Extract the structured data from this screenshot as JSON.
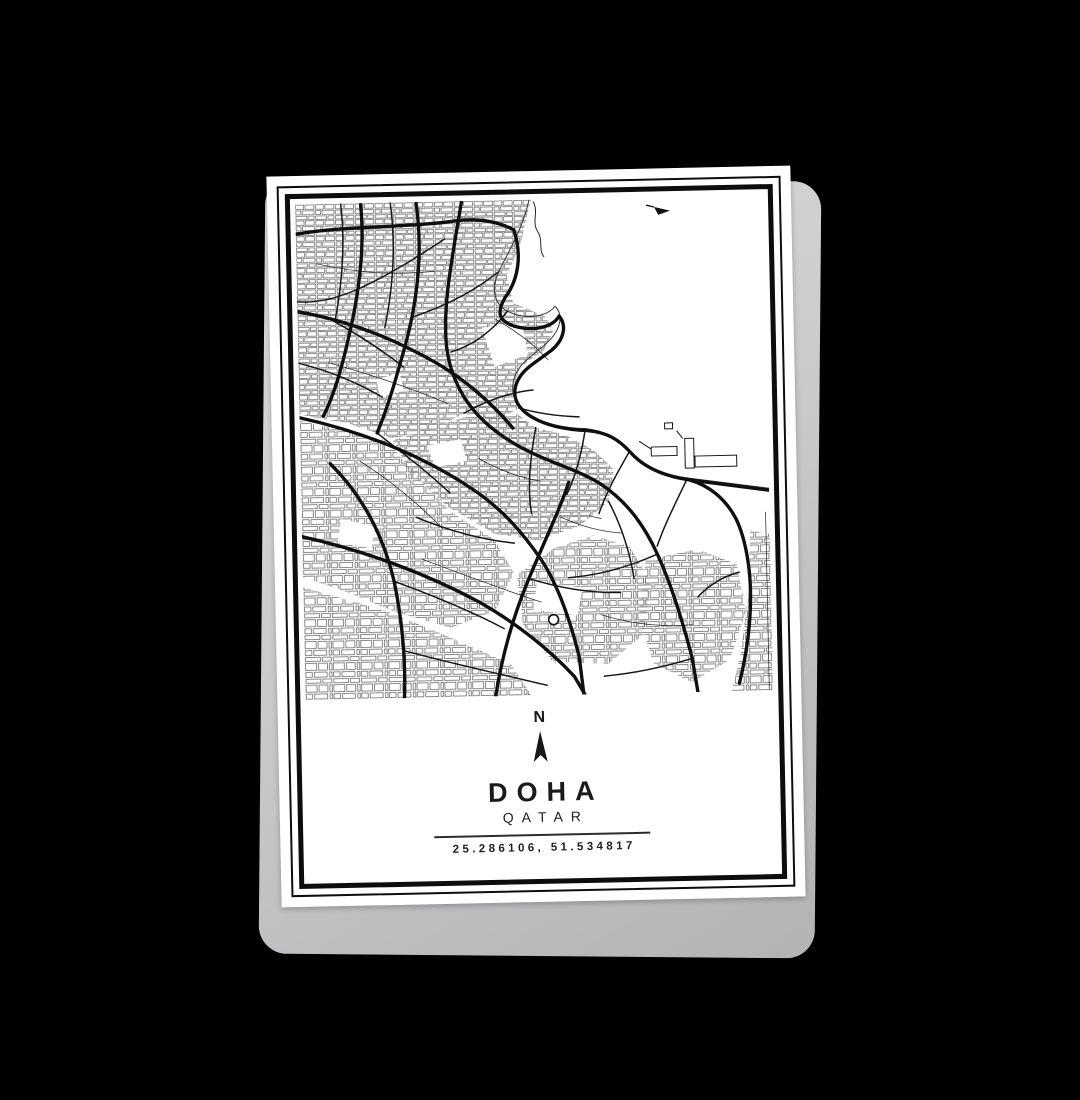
{
  "scene": {
    "background_color": "#000000"
  },
  "poster": {
    "compass": {
      "label": "N",
      "icon": "north-arrow-icon"
    },
    "title": "DOHA",
    "subtitle": "QATAR",
    "coordinates": "25.286106, 51.534817",
    "map": {
      "description": "black and white street map of Doha with bay at top right",
      "water_icon": "boat-icon"
    },
    "colors": {
      "paper": "#ffffff",
      "ink": "#141414",
      "frame": "#0d0d0d",
      "shadow_sheet": "#c6c6c8",
      "background": "#000000"
    }
  }
}
